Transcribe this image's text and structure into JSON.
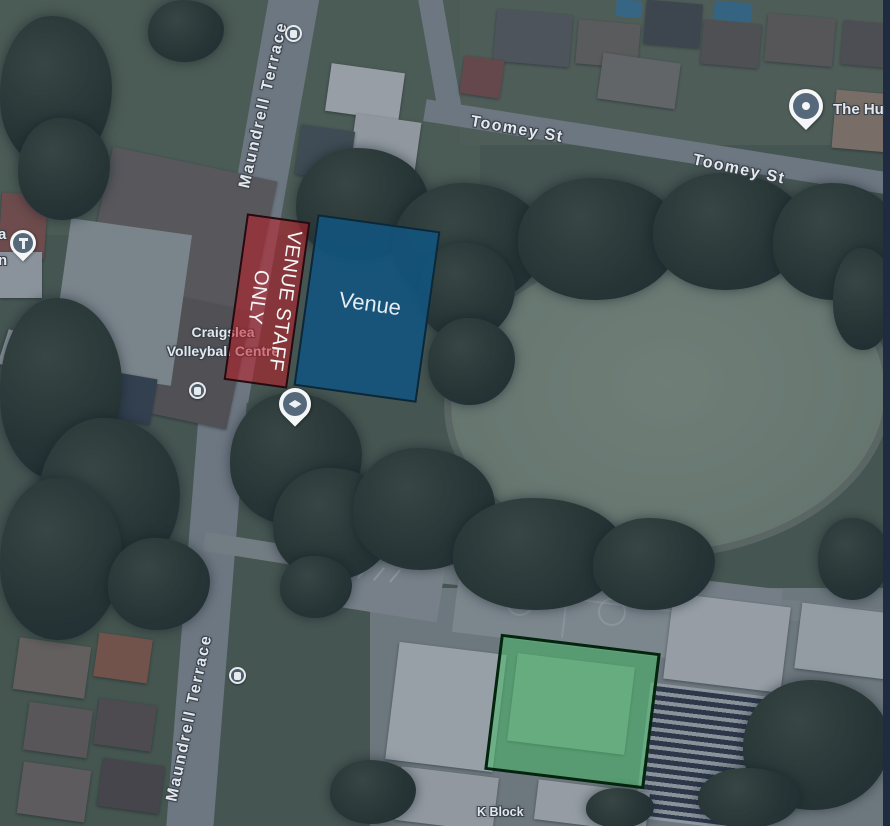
{
  "map_type": "satellite",
  "streets": {
    "maundrell_top": "Maundrell Terrace",
    "maundrell_bottom": "Maundrell Terrace",
    "toomey_west": "Toomey St",
    "toomey_east": "Toomey St"
  },
  "places": {
    "craigslea_line1": "Craigslea",
    "craigslea_line2": "Volleyball Centre",
    "k_block": "K Block",
    "hub_label": "The Hu",
    "church_cut_line1": "a",
    "church_cut_line2": "n"
  },
  "icons": {
    "church_pin": "cross-pin",
    "school_pin": "graduation-cap-pin",
    "hub_pin": "dot-pin",
    "bus_stop": "bus-stop-circle"
  },
  "annotations": {
    "staff_zone": {
      "lines": [
        "VENUE STAFF",
        "ONLY"
      ],
      "fill": "rgba(187,30,38,0.55)",
      "border": "#220c12"
    },
    "venue_zone": {
      "label": "Venue",
      "fill": "rgba(19,84,125,0.9)",
      "border": "#0d2737"
    },
    "highlight_zone": {
      "fill": "rgba(68,190,102,0.5)",
      "border": "#05230e"
    }
  }
}
